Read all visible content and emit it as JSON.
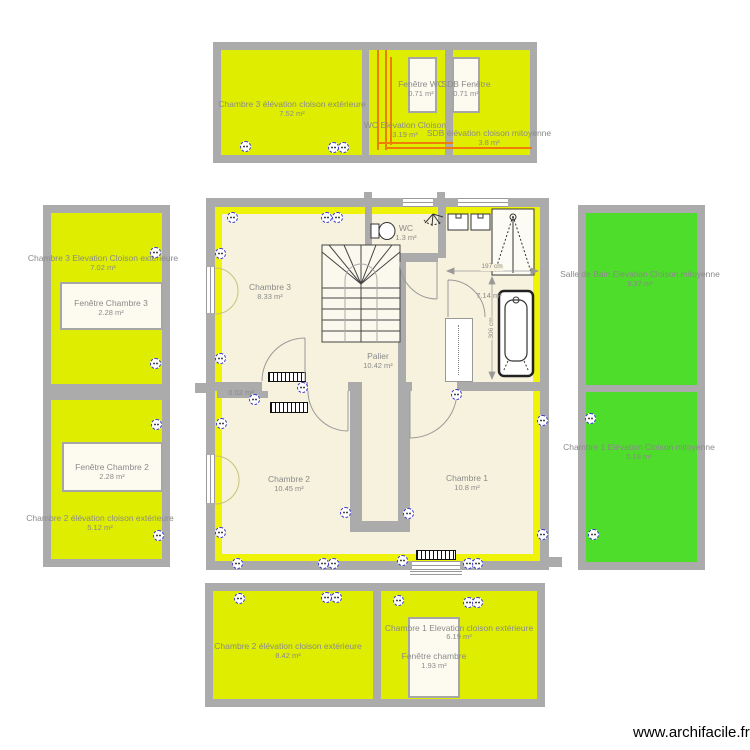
{
  "watermark": "www.archifacile.fr",
  "colors": {
    "panel_yellow": "#dfee00",
    "highlight_yellow": "#eef307",
    "green": "#4edd2b",
    "wall_grey": "#ababab",
    "floor": "#f7f2dd",
    "orange": "#f07d05"
  },
  "top_elevation": {
    "left": {
      "name": "Chambre 3 élévation cloison extérieure",
      "area": "7.52 m²"
    },
    "middle": {
      "name": "WC Elevation Cloison",
      "area": "3.19 m²"
    },
    "right": {
      "name": "SDB élévation cloison mitoyenne",
      "area": "3.8 m²"
    },
    "window_wc": {
      "name": "Fenêtre WC",
      "area": "0.71 m²"
    },
    "window_sdb": {
      "name": "SDB Fenêtre",
      "area": "0.71 m²"
    }
  },
  "left_elevation": {
    "chambre3": {
      "name": "Chambre 3 Elevation Cloison extérieure",
      "area": "7.02 m²"
    },
    "fenetre3": {
      "name": "Fenêtre Chambre 3",
      "area": "2.28 m²"
    },
    "fenetre2": {
      "name": "Fenêtre Chambre 2",
      "area": "2.28 m²"
    },
    "chambre2": {
      "name": "Chambre 2 élévation cloison extérieure",
      "area": "5.12 m²"
    }
  },
  "right_elevation": {
    "sdb": {
      "name": "Salle de Bain Elevation Cloison mitoyenne",
      "area": "9.37 m²"
    },
    "chambre1": {
      "name": "Chambre 1 Elévation Cloison mitoyenne",
      "area": "5.18 m²"
    }
  },
  "bottom_elevation": {
    "chambre2": {
      "name": "Chambre 2 élévation cloison extérieure",
      "area": "8.42 m²"
    },
    "chambre1": {
      "name": "Chambre 1 Elevation cloison extérieure",
      "area": "6.19 m²"
    },
    "fenetre": {
      "name": "Fenêtre chambre",
      "area": "1.93 m²"
    }
  },
  "plan": {
    "chambre3": {
      "name": "Chambre 3",
      "area": "8.33 m²"
    },
    "wc": {
      "name": "WC",
      "area": "1.3 m²"
    },
    "palier": {
      "name": "Palier",
      "area": "10.42 m²"
    },
    "chambre2": {
      "name": "Chambre 2",
      "area": "10.45 m²"
    },
    "chambre1": {
      "name": "Chambre 1",
      "area": "10.8 m²"
    },
    "sliver_area": "0.02 m²",
    "sdb_area": "7.14 m²",
    "dim_width": "197 cm",
    "dim_height": "306 cm",
    "electrical_panel": "TGBT"
  },
  "icons": {
    "outlet": "power-outlet",
    "wall_light": "wall-light",
    "toilet": "toilet",
    "sink": "sink",
    "shower": "shower",
    "bathtub": "bathtub",
    "radiator": "radiator",
    "stairs": "stairs"
  }
}
